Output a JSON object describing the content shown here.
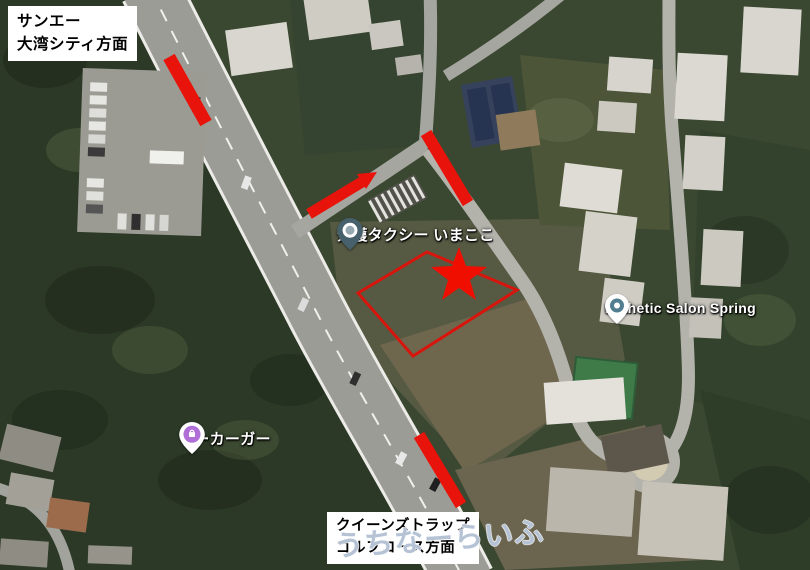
{
  "map": {
    "direction_labels": {
      "top": {
        "line1": "サンエー",
        "line2": "大湾シティ方面"
      },
      "bottom": {
        "line1": "クイーンズトラップ",
        "line2": "ゴルフコース方面"
      }
    },
    "pois": {
      "care_taxi": {
        "label": "介護タクシー いまここ",
        "pin_color": "#46606c"
      },
      "esthetic_salon": {
        "label": "Esthetic Salon Spring",
        "pin_color": "#517e90"
      },
      "marker_shop": {
        "label": "マーカーガー",
        "pin_color": "#b06fd8"
      }
    },
    "watermark": "うちなーらいふ",
    "annotations": {
      "route_color": "#e8130a",
      "star_color": "#ef0e00",
      "parcel_outline_color": "#d8150c"
    }
  }
}
